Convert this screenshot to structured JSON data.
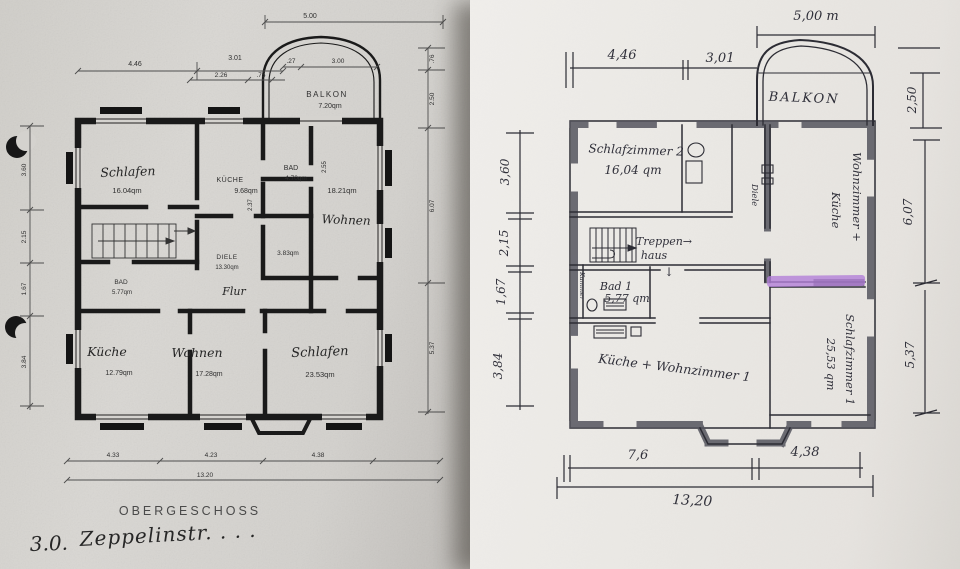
{
  "left": {
    "floor_label": "OBERGESCHOSS",
    "note_prefix": "3.0.",
    "note_text": "Zeppelinstr.  .  .  .",
    "balkon_name": "BALKON",
    "balkon_area": "7.20qm",
    "rooms": {
      "schlafen_a": {
        "name": "Schlafen",
        "area": "16.04qm"
      },
      "kueche_a": {
        "name": "KÜCHE",
        "area": "9.68qm"
      },
      "bad_a": {
        "name": "BAD",
        "area": "4.70qm"
      },
      "wohnen_a": {
        "name": "Wohnen",
        "area": "18.21qm"
      },
      "abstell": {
        "area": "3.83qm"
      },
      "diele": {
        "name": "DIELE",
        "area": "13.30qm"
      },
      "flur": {
        "name": "Flur"
      },
      "bad_b": {
        "name": "BAD",
        "area": "5.77qm"
      },
      "kueche_b": {
        "name": "Küche",
        "area": "12.79qm"
      },
      "wohnen_b": {
        "name": "Wohnen",
        "area": "17.28qm"
      },
      "schlafen_b": {
        "name": "Schlafen",
        "area": "23.53qm"
      }
    },
    "dims": {
      "top": "5.00",
      "w1": "4.46",
      "w2": "3.01",
      "w3": "2.26",
      "w4": ".75",
      "bk1": ".27",
      "bk2": "3.00",
      "r1": ".76",
      "r2": "2.50",
      "r3": "6.07",
      "r4": "5.37",
      "l1": "3.60",
      "l2": "2.15",
      "l3": "1.67",
      "l4": "3.84",
      "b1": "4.33",
      "b2": "4.23",
      "b3": "4.38",
      "total": "13.20",
      "kw": "2.37",
      "wh": "2.55"
    }
  },
  "right": {
    "highlight_color": "#b37fd8",
    "dims": {
      "top": "5,00 m",
      "w1": "4,46",
      "w2": "3,01",
      "r1": "2,50",
      "r2": "6,07",
      "r3": "5,37",
      "l1": "3,60",
      "l2": "2,15",
      "l3": "1,67",
      "l4": "3,84",
      "b1": "7,6",
      "b2": "4,38",
      "total": "13,20"
    },
    "labels": {
      "balkon": "BALKON",
      "sz2": "Schlafzimmer 2",
      "sz2_area": "16,04 qm",
      "treppen": "Treppen→",
      "haus": "haus",
      "arrow": "↓",
      "bad1": "Bad 1",
      "bad1_area": "5,77 qm",
      "kammer": "Kammer",
      "kw1": "Küche + Wohnzimmer 1",
      "wzk1": "Wohnzimmer +",
      "wzk2": "Küche",
      "diele": "Diele",
      "sz1": "Schlafzimmer 1",
      "sz1_area": "25,53 qm"
    }
  }
}
